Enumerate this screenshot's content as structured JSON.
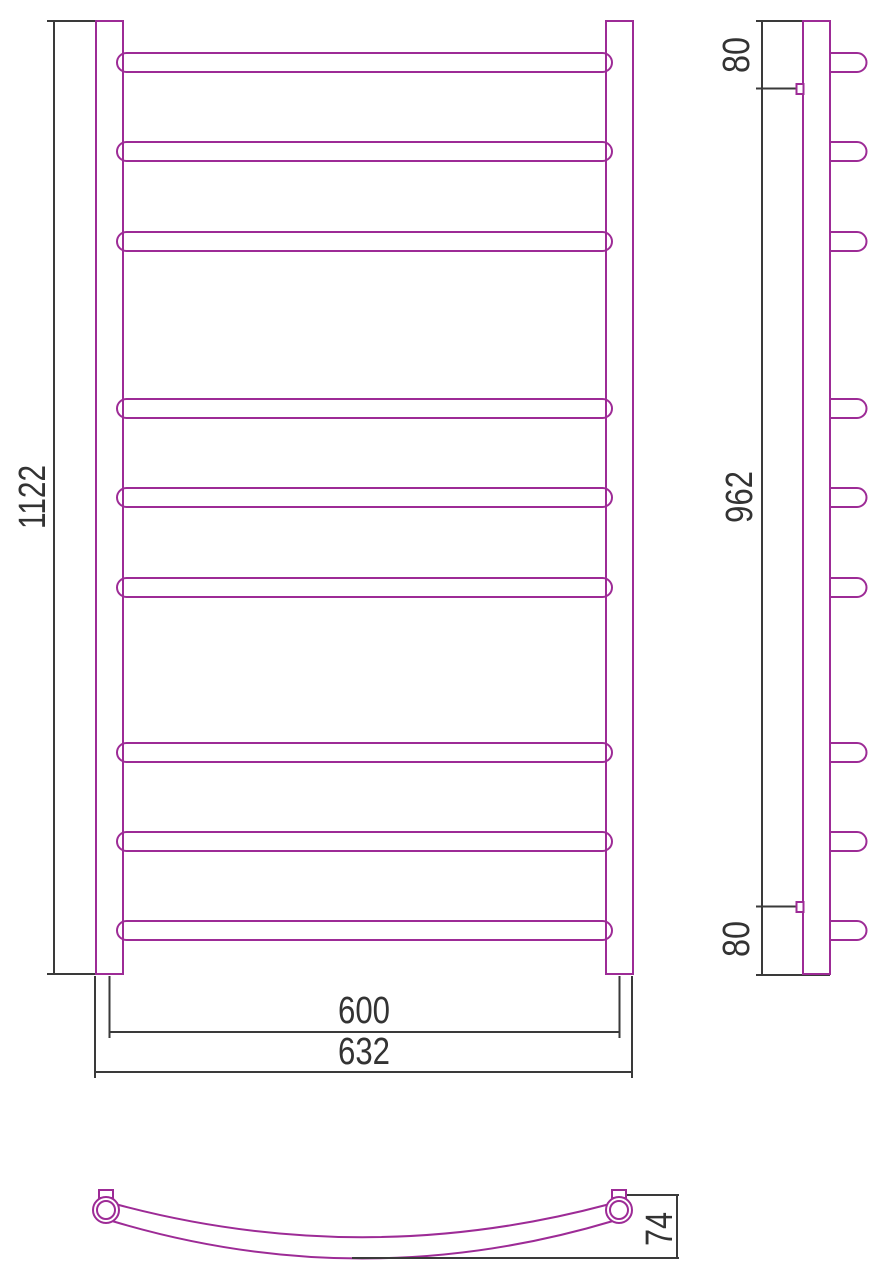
{
  "meta": {
    "type": "technical drawing",
    "subject": "ladder-style curved towel rail, three orthographic views"
  },
  "colors": {
    "product_outline": "#9D2B96",
    "dimension_lines": "#3A3A3A",
    "text": "#333333",
    "background": "#FFFFFF"
  },
  "front_view": {
    "rung_count": 9,
    "dim_height": "1122",
    "dim_width_centers": "600",
    "dim_width_overall": "632"
  },
  "side_view": {
    "rung_count": 9,
    "dim_top_offset": "80",
    "dim_bracket_span": "962",
    "dim_bottom_offset": "80"
  },
  "top_view": {
    "dim_curve_depth": "74"
  }
}
